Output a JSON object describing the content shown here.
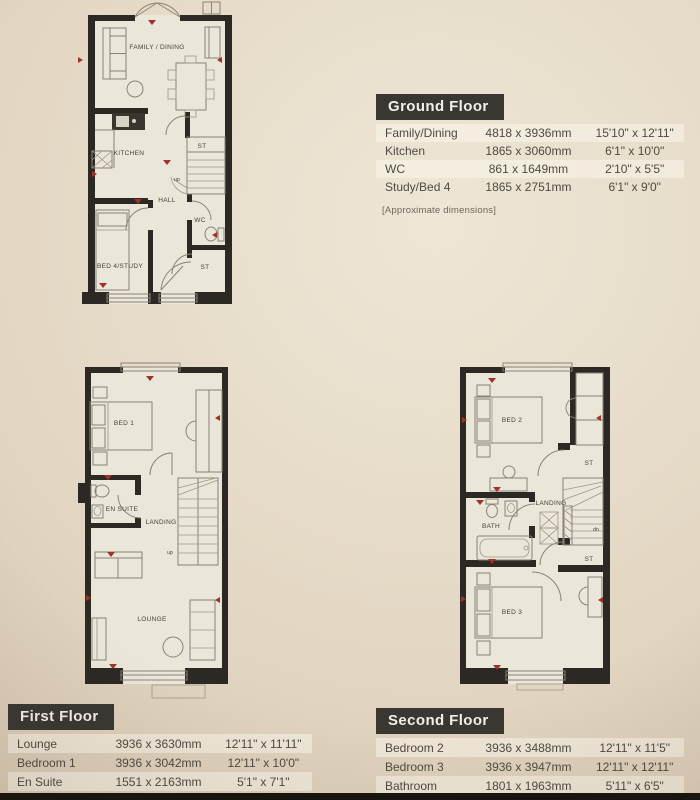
{
  "colors": {
    "accent_red": "#a23227",
    "wall": "#2c2823",
    "header_bg": "#3a3733",
    "page_beige": "#e3d7c3",
    "plan_paper": "#ebe6da"
  },
  "tables": {
    "ground": {
      "title": "Ground Floor",
      "note": "[Approximate dimensions]",
      "rows": [
        {
          "room": "Family/Dining",
          "metric": "4818 x 3936mm",
          "imperial": "15'10\" x 12'11\""
        },
        {
          "room": "Kitchen",
          "metric": "1865 x 3060mm",
          "imperial": "6'1\" x 10'0\""
        },
        {
          "room": "WC",
          "metric": "861 x 1649mm",
          "imperial": "2'10\" x 5'5\""
        },
        {
          "room": "Study/Bed 4",
          "metric": "1865 x 2751mm",
          "imperial": "6'1\" x 9'0\""
        }
      ]
    },
    "first": {
      "title": "First Floor",
      "rows": [
        {
          "room": "Lounge",
          "metric": "3936 x 3630mm",
          "imperial": "12'11\" x 11'11\""
        },
        {
          "room": "Bedroom 1",
          "metric": "3936 x 3042mm",
          "imperial": "12'11\" x 10'0\""
        },
        {
          "room": "En Suite",
          "metric": "1551 x 2163mm",
          "imperial": "5'1\" x 7'1\""
        }
      ]
    },
    "second": {
      "title": "Second Floor",
      "rows": [
        {
          "room": "Bedroom 2",
          "metric": "3936 x 3488mm",
          "imperial": "12'11\" x 11'5\""
        },
        {
          "room": "Bedroom 3",
          "metric": "3936 x 3947mm",
          "imperial": "12'11\" x 12'11\""
        },
        {
          "room": "Bathroom",
          "metric": "1801 x 1963mm",
          "imperial": "5'11\" x 6'5\""
        }
      ]
    }
  },
  "plans": {
    "ground": {
      "labels": {
        "family_dining": "FAMILY / DINING",
        "kitchen": "KITCHEN",
        "st_upper": "ST",
        "up": "up",
        "hall": "HALL",
        "wc": "WC",
        "st_lower": "ST",
        "bed4_study": "BED 4/STUDY"
      }
    },
    "first": {
      "labels": {
        "bed1": "BED 1",
        "en_suite": "EN SUITE",
        "landing": "LANDING",
        "up": "up",
        "lounge": "LOUNGE"
      }
    },
    "second": {
      "labels": {
        "bed2": "BED 2",
        "st_upper": "ST",
        "bath": "BATH",
        "landing": "LANDING",
        "up": "up",
        "st_lower": "ST",
        "bed3": "BED 3"
      }
    }
  }
}
